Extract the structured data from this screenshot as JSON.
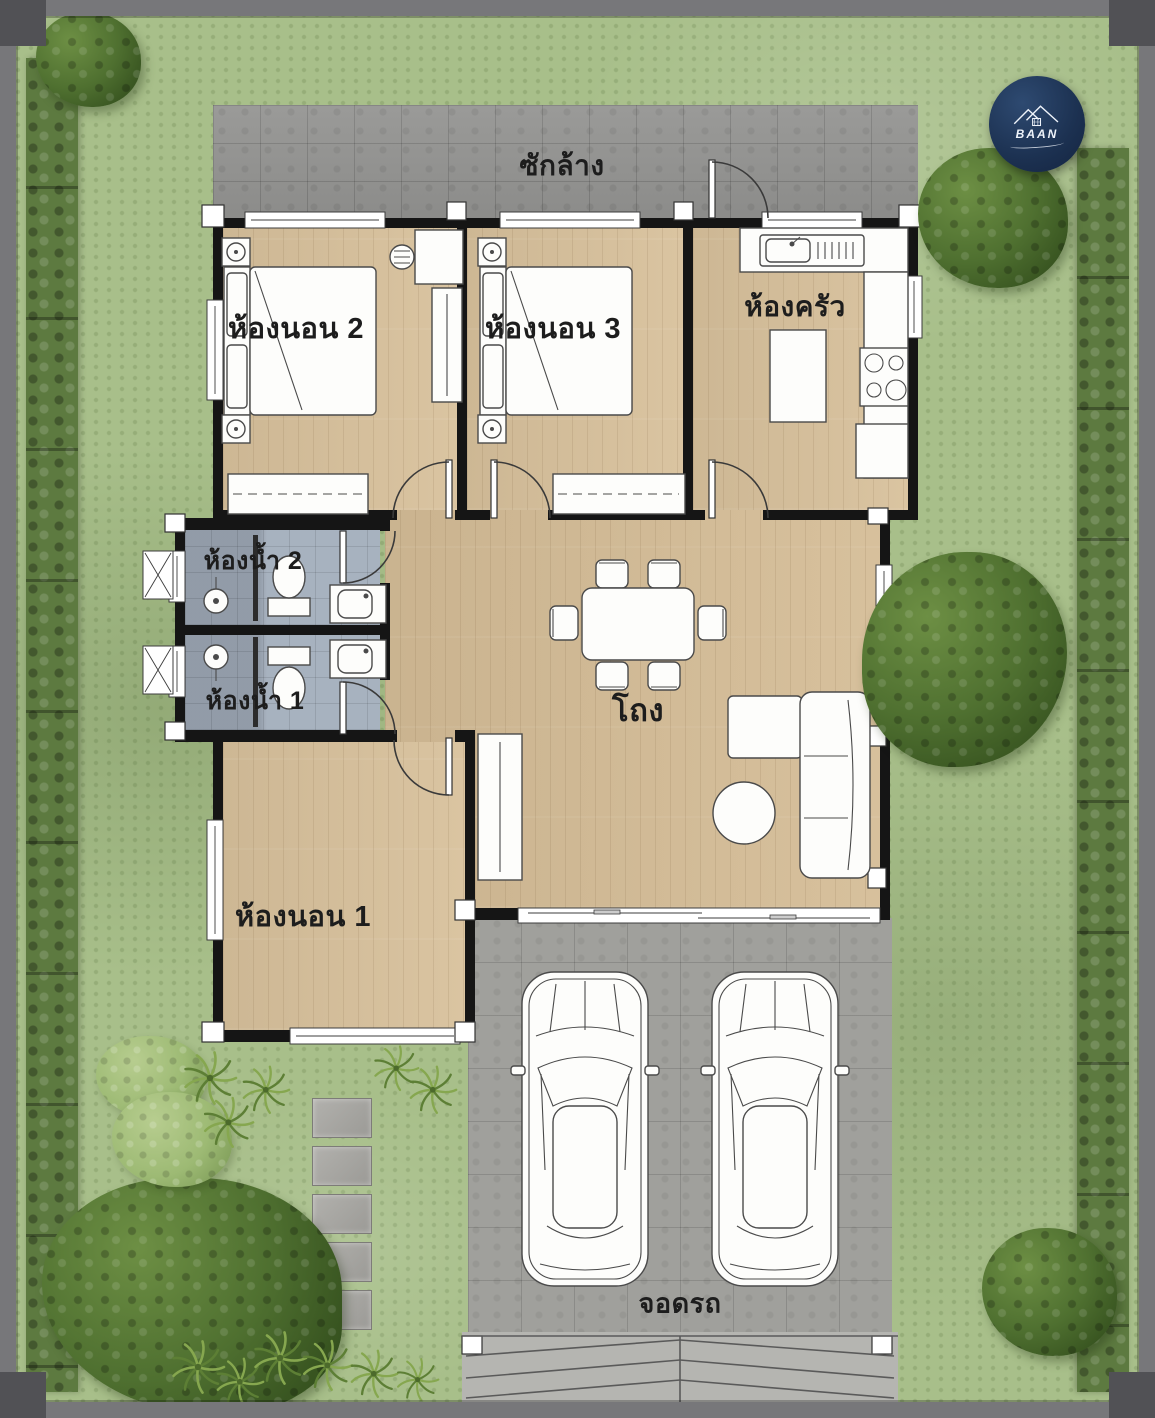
{
  "logo": {
    "brand": "BAAN"
  },
  "rooms": {
    "laundry": {
      "label": "ซักล้าง"
    },
    "bedroom2": {
      "label": "ห้องนอน 2"
    },
    "bedroom3": {
      "label": "ห้องนอน 3"
    },
    "kitchen": {
      "label": "ห้องครัว"
    },
    "bathroom2": {
      "label": "ห้องน้ำ 2"
    },
    "bathroom1": {
      "label": "ห้องน้ำ 1"
    },
    "hall": {
      "label": "โถง"
    },
    "bedroom1": {
      "label": "ห้องนอน 1"
    },
    "parking": {
      "label": "จอดรถ"
    }
  },
  "icons": {
    "logo_house": "house-roof-icon",
    "shower": "shower-head-icon",
    "stove": "stove-burners-icon"
  },
  "colors": {
    "grass": "#a8bf8a",
    "hedge": "#5d7a40",
    "tree": "#4f7030",
    "deck_grey": "#949492",
    "parking_grey": "#a0a09c",
    "driveway_grey": "#b5b5b1",
    "wood_floor": "#d8c19c",
    "bath_floor": "#a2adbb",
    "wall": "#151515",
    "fixture_white": "#fdfdfb",
    "label_text": "#1d1d1d",
    "logo_navy": "#1c3151",
    "frame_grey": "#77777a"
  }
}
